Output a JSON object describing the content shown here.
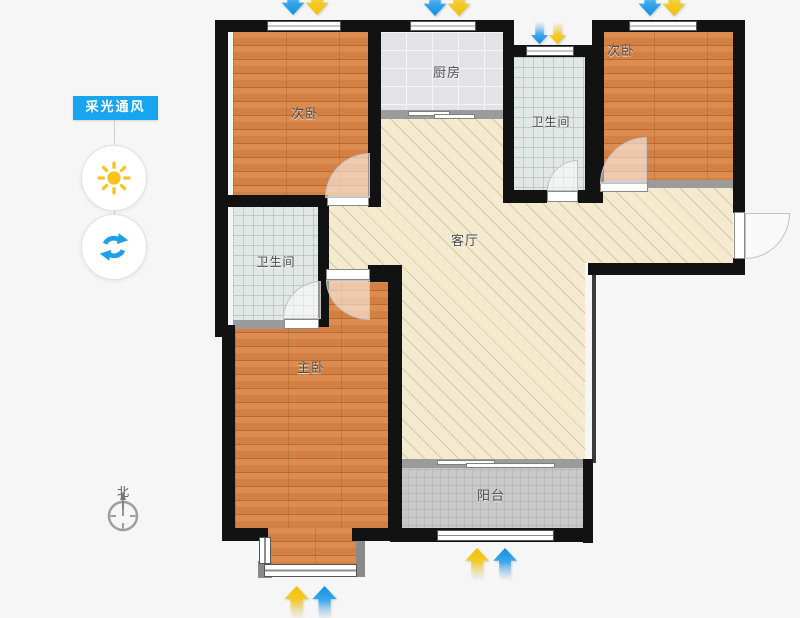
{
  "view": {
    "mode_badge": "采光通风"
  },
  "sidebar": {
    "panel_label": "采光通风",
    "buttons": [
      {
        "id": "daylight",
        "icon": "sun-icon",
        "color": "#f7c41d"
      },
      {
        "id": "ventilation",
        "icon": "refresh-icon",
        "color": "#1e9fe8"
      }
    ],
    "badge_bg": "#18a5ef"
  },
  "compass": {
    "north_label": "北",
    "icon": "compass-icon"
  },
  "floorplan": {
    "rooms": [
      {
        "id": "bedroom-top-left",
        "label": "次卧",
        "floor": "wood"
      },
      {
        "id": "kitchen",
        "label": "厨房",
        "floor": "ceramic-tile"
      },
      {
        "id": "bathroom-top",
        "label": "卫生间",
        "floor": "mosaic-tile"
      },
      {
        "id": "bedroom-top-right",
        "label": "次卧",
        "floor": "wood"
      },
      {
        "id": "living-room",
        "label": "客厅",
        "floor": "diagonal-hatch"
      },
      {
        "id": "bathroom-left",
        "label": "卫生间",
        "floor": "mosaic-tile"
      },
      {
        "id": "master-bedroom",
        "label": "主卧",
        "floor": "wood"
      },
      {
        "id": "balcony",
        "label": "阳台",
        "floor": "gray-mosaic"
      }
    ],
    "arrows": {
      "wind_icon": "wind-arrow",
      "light_icon": "light-arrow",
      "wind_color": "#1e98ea",
      "light_color": "#f6c40e",
      "top_pairs": 4,
      "bottom_pairs": 2
    },
    "colors": {
      "wall": "#121212",
      "light_wall": "#9b9b9b",
      "wood_floor": "#d07c3c",
      "living_floor": "#f3ead0",
      "background": "#f6f6f7"
    }
  }
}
